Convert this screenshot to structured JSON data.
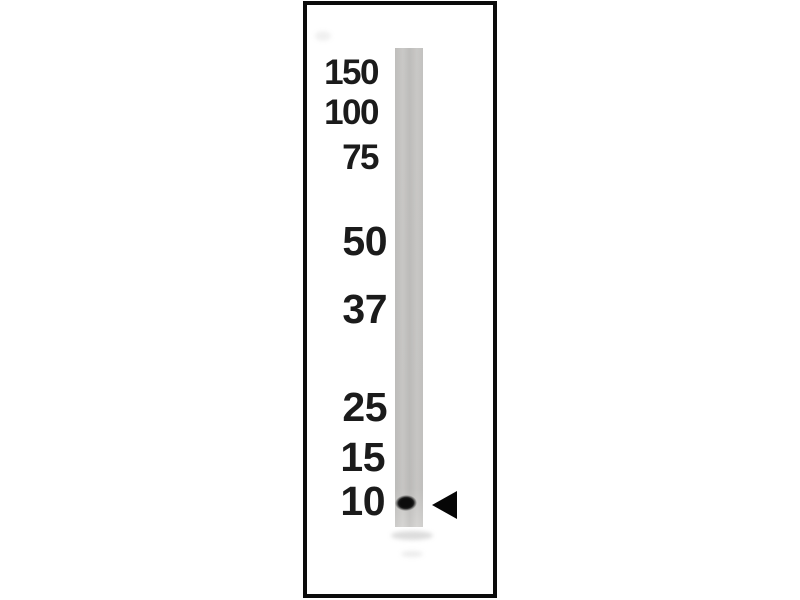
{
  "blot": {
    "markers": [
      {
        "label": "150"
      },
      {
        "label": "100"
      },
      {
        "label": "75"
      },
      {
        "label": "50"
      },
      {
        "label": "37"
      },
      {
        "label": "25"
      },
      {
        "label": "15"
      },
      {
        "label": "10"
      }
    ],
    "figure_data": {
      "type": "western_blot",
      "ladder_kda": [
        150,
        100,
        75,
        50,
        37,
        25,
        15,
        10
      ],
      "lane_count": 1,
      "bands": [
        {
          "lane": 1,
          "kda": 10
        }
      ],
      "annotations": [
        {
          "shape": "arrowhead",
          "direction": "left",
          "points_to_kda": 10
        }
      ]
    },
    "colors": {
      "background": "#ffffff",
      "panel_border": "#0b0b0b",
      "lane_gray": "#c7c6c4",
      "band_black": "#0c0c0c",
      "label_text": "#1b1b1b"
    }
  }
}
